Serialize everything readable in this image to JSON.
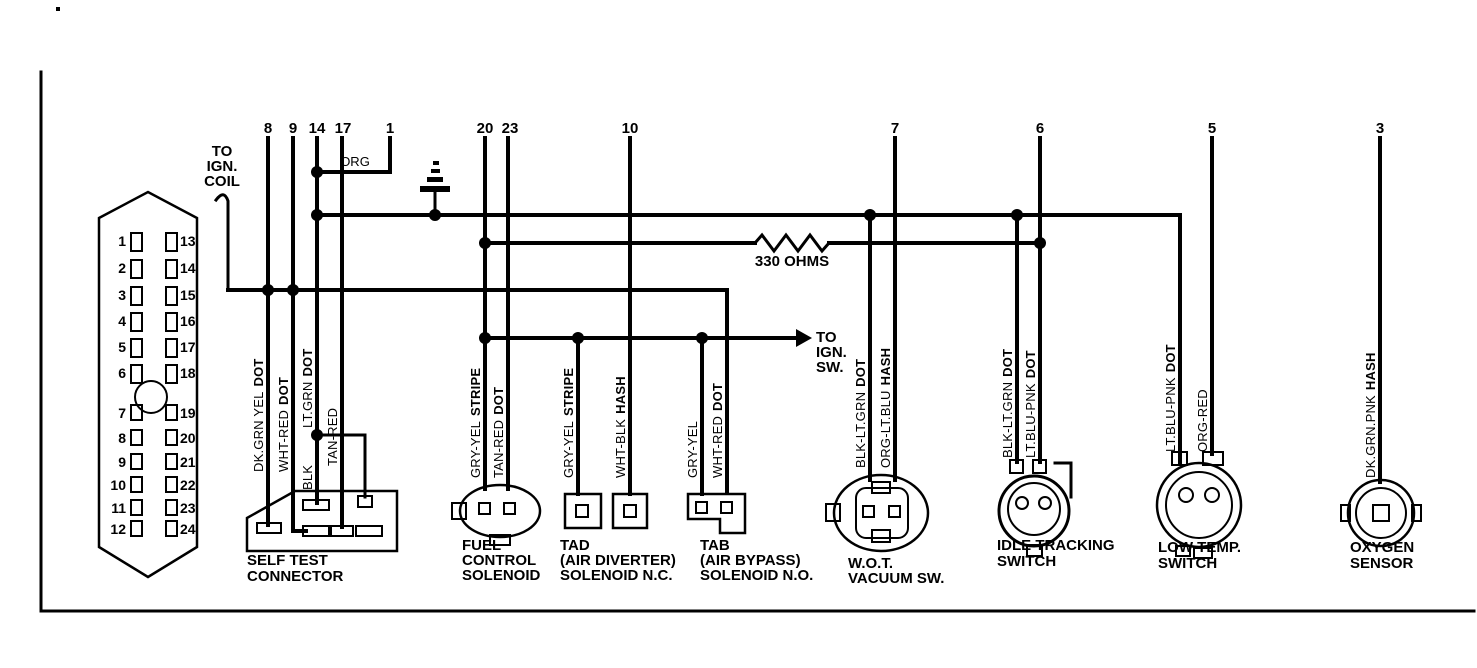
{
  "colors": {
    "ink": "#000000",
    "paper": "#ffffff"
  },
  "top_pins": [
    "8",
    "9",
    "14",
    "17",
    "1",
    "20",
    "23",
    "10",
    "7",
    "6",
    "5",
    "3"
  ],
  "connector_block": {
    "left_pins": [
      "1",
      "2",
      "3",
      "4",
      "5",
      "6",
      "7",
      "8",
      "9",
      "10",
      "11",
      "12"
    ],
    "right_pins": [
      "13",
      "14",
      "15",
      "16",
      "17",
      "18",
      "19",
      "20",
      "21",
      "22",
      "23",
      "24"
    ]
  },
  "notes": {
    "to_ign_coil": [
      "TO",
      "IGN.",
      "COIL"
    ],
    "to_ign_sw": [
      "TO",
      "IGN.",
      "SW."
    ],
    "org": "ORG",
    "resistor": "330 OHMS"
  },
  "wire_labels": [
    {
      "plain": "DK.GRN YEL",
      "bold": "DOT"
    },
    {
      "plain": "WHT-RED",
      "bold": "DOT"
    },
    {
      "plain": "BLK",
      "bold": ""
    },
    {
      "plain": "LT.GRN",
      "bold": "DOT"
    },
    {
      "plain": "TAN-RED",
      "bold": ""
    },
    {
      "plain": "GRY-YEL",
      "bold": "STRIPE"
    },
    {
      "plain": "TAN-RED",
      "bold": "DOT"
    },
    {
      "plain": "GRY-YEL",
      "bold": "STRIPE"
    },
    {
      "plain": "WHT-BLK",
      "bold": "HASH"
    },
    {
      "plain": "GRY-YEL",
      "bold": ""
    },
    {
      "plain": "WHT-RED",
      "bold": "DOT"
    },
    {
      "plain": "BLK-LT.GRN",
      "bold": "DOT"
    },
    {
      "plain": "ORG-LT.BLU",
      "bold": "HASH"
    },
    {
      "plain": "BLK-LT.GRN",
      "bold": "DOT"
    },
    {
      "plain": "LT.BLU-PNK",
      "bold": "DOT"
    },
    {
      "plain": "LT.BLU-PNK",
      "bold": "DOT"
    },
    {
      "plain": "ORG-RED",
      "bold": ""
    },
    {
      "plain": "DK.GRN.PNK",
      "bold": "HASH"
    }
  ],
  "components": [
    {
      "label_lines": [
        "SELF TEST",
        "CONNECTOR"
      ]
    },
    {
      "label_lines": [
        "FUEL",
        "CONTROL",
        "SOLENOID"
      ]
    },
    {
      "label_lines": [
        "TAD",
        "(AIR DIVERTER)",
        "SOLENOID N.C."
      ]
    },
    {
      "label_lines": [
        "TAB",
        "(AIR BYPASS)",
        "SOLENOID N.O."
      ]
    },
    {
      "label_lines": [
        "W.O.T.",
        "VACUUM SW."
      ]
    },
    {
      "label_lines": [
        "IDLE TRACKING",
        "SWITCH"
      ]
    },
    {
      "label_lines": [
        "LOW TEMP.",
        "SWITCH"
      ]
    },
    {
      "label_lines": [
        "OXYGEN",
        "SENSOR"
      ]
    }
  ]
}
